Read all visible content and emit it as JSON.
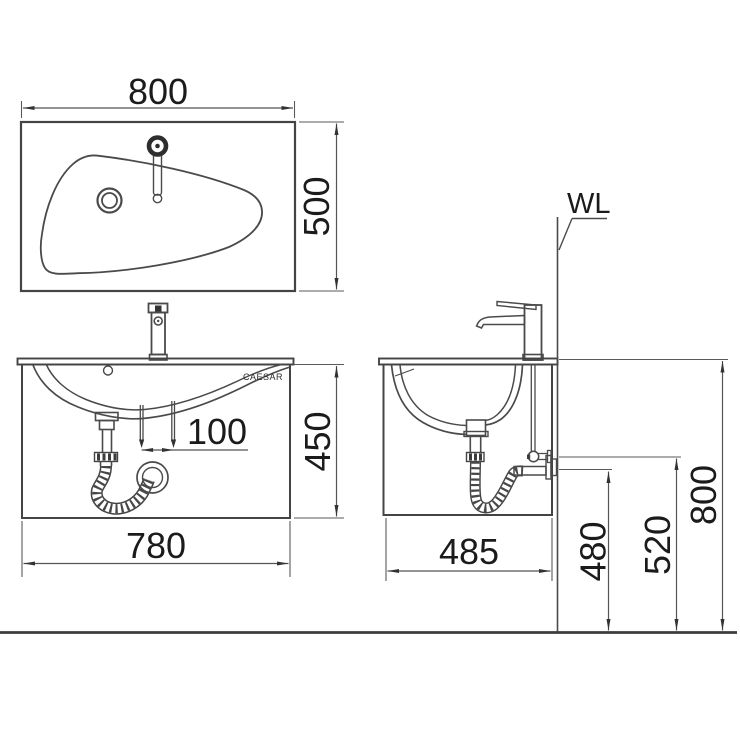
{
  "drawing": {
    "brand_label": "CAESAR",
    "wall_line_label": "WL",
    "top_view": {
      "width": "800",
      "depth": "500"
    },
    "front_view": {
      "width": "780",
      "height": "450",
      "faucet_hole_spacing": "100"
    },
    "side_view": {
      "depth": "485",
      "drain_outlet_height": "480",
      "supply_valve_height": "520",
      "rim_height": "800"
    },
    "colors": {
      "line": "#444444",
      "dim_line": "#555555",
      "text": "#1b1b1b",
      "background": "#ffffff"
    }
  }
}
